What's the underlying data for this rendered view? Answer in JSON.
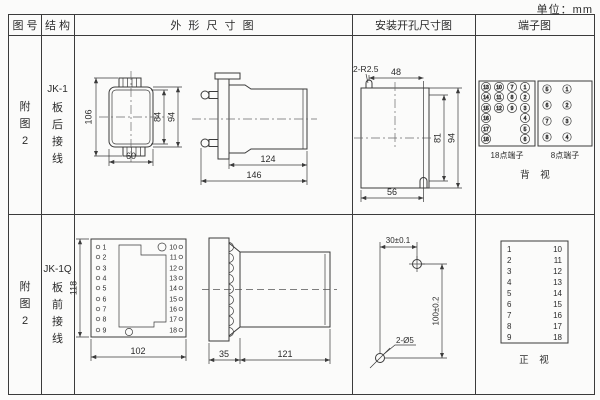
{
  "unit_label": "单位：mm",
  "header": {
    "fig_no": "图 号",
    "structure": "结 构",
    "outline": "外 形 尺 寸 图",
    "install": "安装开孔尺寸图",
    "terminal": "端子图"
  },
  "row1": {
    "fig_lines": [
      "附",
      "图",
      "2"
    ],
    "model": "JK-1",
    "structure_lines": [
      "板",
      "后",
      "接",
      "线"
    ],
    "outline_dims": {
      "total_height": "106",
      "inner_height": "84",
      "outer_height": "94",
      "width": "60",
      "body_depth": "124",
      "total_depth": "146"
    },
    "install_dims": {
      "slot_label": "2-R2.5",
      "top_width": "48",
      "inner_height": "81",
      "outer_height": "94",
      "bottom_width": "56"
    },
    "terminals": {
      "p18_label": "18点端子",
      "p8_label": "8点端子",
      "view_label": "背 视",
      "p18_grid": [
        [
          "13",
          "10",
          "7",
          "1"
        ],
        [
          "14",
          "11",
          "8",
          "2"
        ],
        [
          "15",
          "12",
          "9",
          "3"
        ],
        [
          "16",
          "",
          "",
          "4"
        ],
        [
          "17",
          "",
          "",
          "5"
        ],
        [
          "18",
          "",
          "",
          "6"
        ]
      ],
      "p8_grid": [
        [
          "5",
          "1"
        ],
        [
          "6",
          "2"
        ],
        [
          "7",
          "3"
        ],
        [
          "8",
          "4"
        ]
      ]
    }
  },
  "row2": {
    "fig_lines": [
      "附",
      "图",
      "2"
    ],
    "model": "JK-1Q",
    "structure_lines": [
      "板",
      "前",
      "接",
      "线"
    ],
    "outline_dims": {
      "height": "118",
      "width": "102",
      "panel_depth": "35",
      "body_depth": "121"
    },
    "panel_terminals": {
      "left": [
        "1",
        "2",
        "3",
        "4",
        "5",
        "6",
        "7",
        "8",
        "9"
      ],
      "right": [
        "10",
        "11",
        "12",
        "13",
        "14",
        "15",
        "16",
        "17",
        "18"
      ]
    },
    "install_dims": {
      "hole_spacing_h": "30±0.1",
      "hole_spacing_v": "100±0.2",
      "hole_label": "2-Ø5"
    },
    "terminals": {
      "left": [
        "1",
        "2",
        "3",
        "4",
        "5",
        "6",
        "7",
        "8",
        "9"
      ],
      "right": [
        "10",
        "11",
        "12",
        "13",
        "14",
        "15",
        "16",
        "17",
        "18"
      ],
      "view_label": "正 视"
    }
  }
}
